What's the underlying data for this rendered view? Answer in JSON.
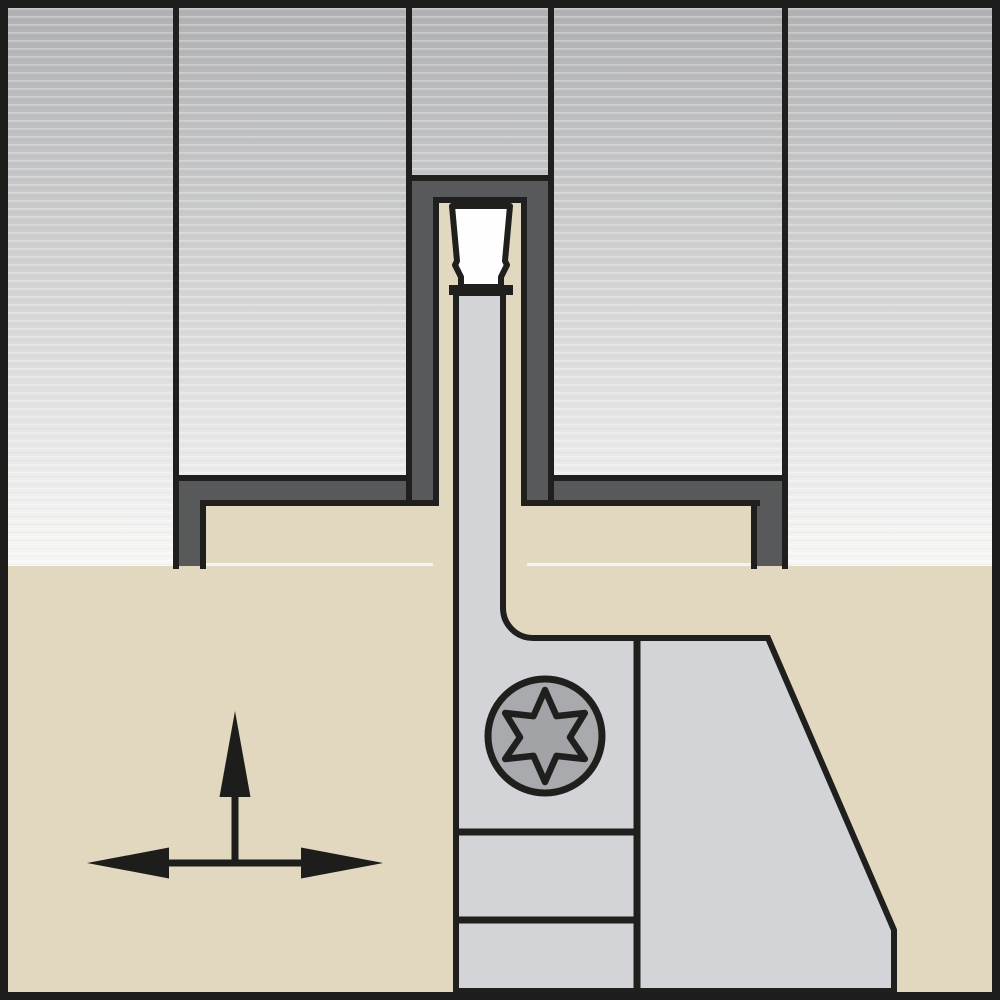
{
  "diagram": {
    "title": "Grooving tool and workpiece cross-section illustration",
    "type": "technical-line-art",
    "visible_text": [],
    "palette": {
      "frame_black": "#1d1d1b",
      "outline_black": "#1f1f1d",
      "workpiece_top": "#b0b1b3",
      "workpiece_bottom": "#f7f7f6",
      "cut_shade_gray": "#58595b",
      "holder_tan": "#e2d7bf",
      "tool_gray": "#d3d4d8",
      "screw_head_gray": "#a9aaae",
      "screw_star_gray": "#a2a3a7",
      "insert_white": "#fefefe",
      "arrow_black": "#1d1d1b"
    },
    "parts": {
      "workpiece": "machined workpiece shown as gray gradient panels with horizontal texture",
      "cut_faces": "dark gray shaded surfaces of the machined groove and steps",
      "toolholder": "tan grooving tool holder body",
      "blade": "narrow gray support blade reaching up into the groove",
      "insert": "white cutting insert clamped at top of blade",
      "head": "gray tool head with front clamp and angled back edge",
      "screw": "torx-drive clamp screw, six-lobe star",
      "arrows": "feed direction indicators: one vertical up arrow, one horizontal double-headed arrow"
    },
    "screw": {
      "drive": "torx",
      "lobes": 6
    },
    "arrows": {
      "vertical": "up",
      "horizontal": "left-right"
    }
  }
}
